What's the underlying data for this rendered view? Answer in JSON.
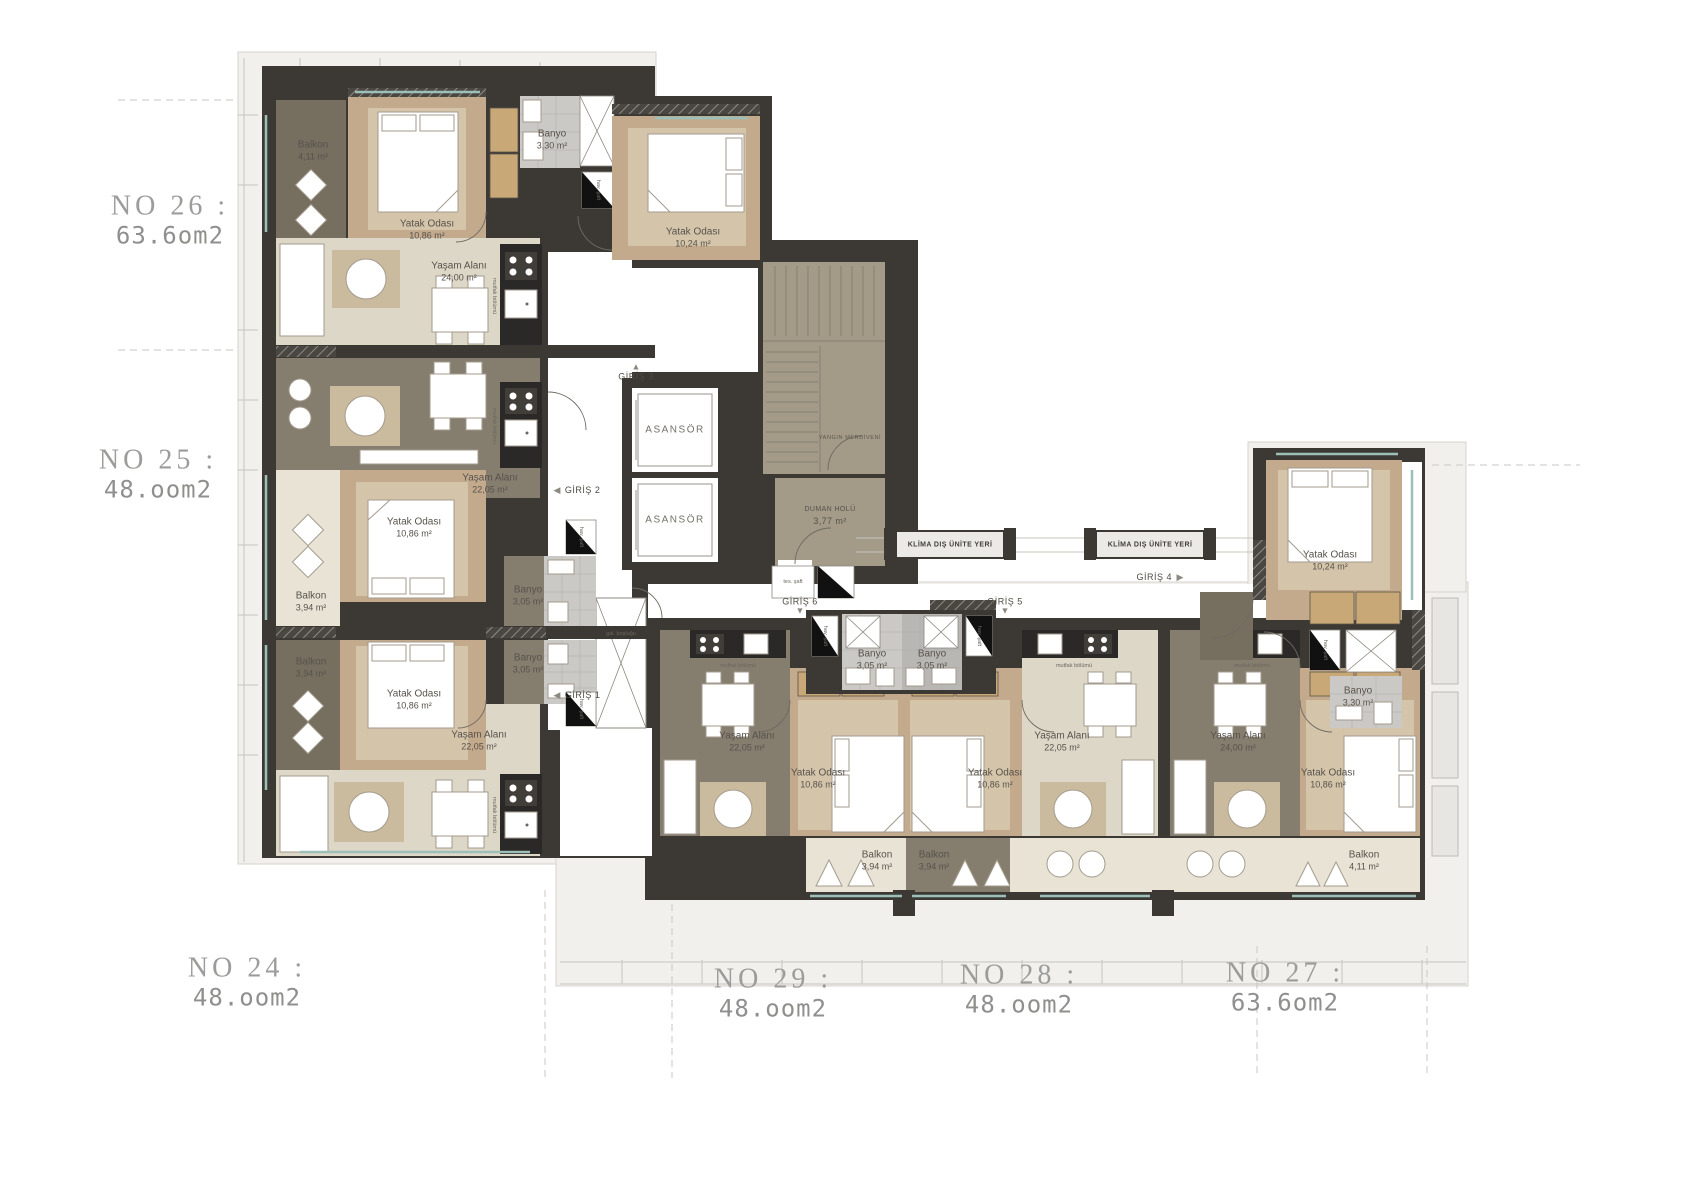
{
  "title": "Apartment floor plan",
  "units": [
    {
      "no": "NO 26 :",
      "area": "63.6om2",
      "rooms": {
        "balkon": {
          "name": "Balkon",
          "area": "4,11 m²"
        },
        "yatak1": {
          "name": "Yatak Odası",
          "area": "10,86 m²"
        },
        "banyo": {
          "name": "Banyo",
          "area": "3,30 m²"
        },
        "yatak2": {
          "name": "Yatak Odası",
          "area": "10,24 m²"
        },
        "yasam": {
          "name": "Yaşam Alanı",
          "area": "24,00 m²"
        }
      }
    },
    {
      "no": "NO 25 :",
      "area": "48.oom2",
      "rooms": {
        "yasam": {
          "name": "Yaşam Alanı",
          "area": "22,05 m²"
        },
        "yatak": {
          "name": "Yatak Odası",
          "area": "10,86 m²"
        },
        "balkon": {
          "name": "Balkon",
          "area": "3,94 m²"
        },
        "banyo": {
          "name": "Banyo",
          "area": "3,05 m²"
        }
      }
    },
    {
      "no": "NO 24 :",
      "area": "48.oom2",
      "rooms": {
        "balkon": {
          "name": "Balkon",
          "area": "3,94 m²"
        },
        "yatak": {
          "name": "Yatak Odası",
          "area": "10,86 m²"
        },
        "banyo": {
          "name": "Banyo",
          "area": "3,05 m²"
        },
        "yasam": {
          "name": "Yaşam Alanı",
          "area": "22,05 m²"
        }
      }
    },
    {
      "no": "NO 29 :",
      "area": "48.oom2",
      "rooms": {
        "banyo": {
          "name": "Banyo",
          "area": "3,05 m²"
        },
        "yasam": {
          "name": "Yaşam Alanı",
          "area": "22,05 m²"
        },
        "yatak": {
          "name": "Yatak Odası",
          "area": "10,86 m²"
        },
        "balkon": {
          "name": "Balkon",
          "area": "3,94 m²"
        }
      }
    },
    {
      "no": "NO 28 :",
      "area": "48.oom2",
      "rooms": {
        "banyo": {
          "name": "Banyo",
          "area": "3,05 m²"
        },
        "yatak": {
          "name": "Yatak Odası",
          "area": "10,86 m²"
        },
        "yasam": {
          "name": "Yaşam Alanı",
          "area": "22,05 m²"
        },
        "balkon": {
          "name": "Balkon",
          "area": "3,94 m²"
        }
      }
    },
    {
      "no": "NO 27 :",
      "area": "63.6om2",
      "rooms": {
        "yatak2": {
          "name": "Yatak Odası",
          "area": "10,24 m²"
        },
        "banyo": {
          "name": "Banyo",
          "area": "3,30 m²"
        },
        "yasam": {
          "name": "Yaşam Alanı",
          "area": "24,00 m²"
        },
        "yatak1": {
          "name": "Yatak Odası",
          "area": "10,86 m²"
        },
        "balkon": {
          "name": "Balkon",
          "area": "4,11 m²"
        }
      }
    }
  ],
  "core": {
    "asansor": "ASANSÖR",
    "yangin_merdiveni": "YANGIN MERDİVENİ",
    "duman_holu": {
      "name": "DUMAN HOLÜ",
      "area": "3,77 m²"
    },
    "klima": "KLİMA DIŞ ÜNİTE YERİ",
    "giris": [
      "GİRİŞ 1",
      "GİRİŞ 2",
      "GİRİŞ 3",
      "GİRİŞ 4",
      "GİRİŞ 5",
      "GİRİŞ 6"
    ],
    "tes_saft": "tes. şaft",
    "hav_saft": "hav. şaft",
    "gal_boslugu": "gal. boşluğu",
    "mutfak": "mutfak bölümü",
    "tri_up": "▲",
    "tri_down": "▼",
    "tri_left": "◀",
    "tri_right": "▶"
  }
}
